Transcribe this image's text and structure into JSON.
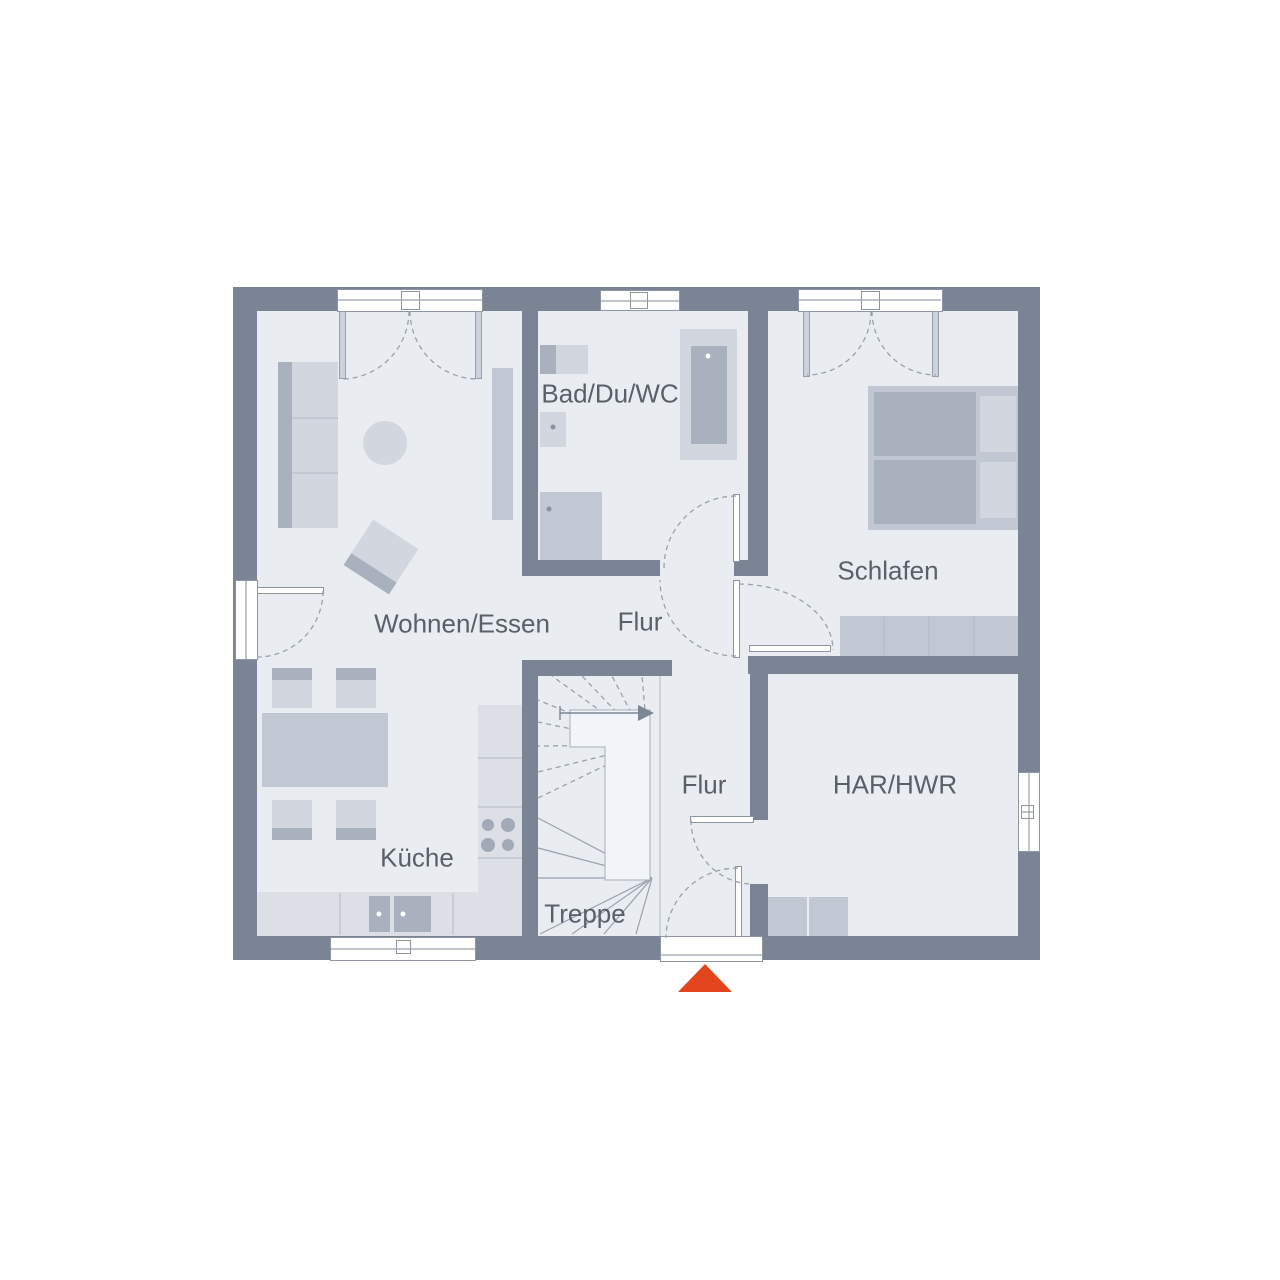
{
  "floorplan": {
    "rooms": [
      {
        "id": "bad-du-wc",
        "label": "Bad/Du/WC"
      },
      {
        "id": "schlafen",
        "label": "Schlafen"
      },
      {
        "id": "wohnen-essen",
        "label": "Wohnen/Essen"
      },
      {
        "id": "flur-upper",
        "label": "Flur"
      },
      {
        "id": "flur-lower",
        "label": "Flur"
      },
      {
        "id": "kueche",
        "label": "Küche"
      },
      {
        "id": "treppe",
        "label": "Treppe"
      },
      {
        "id": "har-hwr",
        "label": "HAR/HWR"
      }
    ],
    "entrance_marker": {
      "icon": "triangle-up-icon",
      "color": "#e2441d"
    },
    "colors": {
      "wall": "#7b8494",
      "floor": "#e9ecf1",
      "furniture": "#d2d6df",
      "furniture_mid": "#c6ccd6",
      "furniture_dark": "#aab1be",
      "counter": "#dcdfe6",
      "line": "#99a1af",
      "text": "#5a6069",
      "accent": "#e2441d",
      "window": "#ffffff"
    }
  }
}
